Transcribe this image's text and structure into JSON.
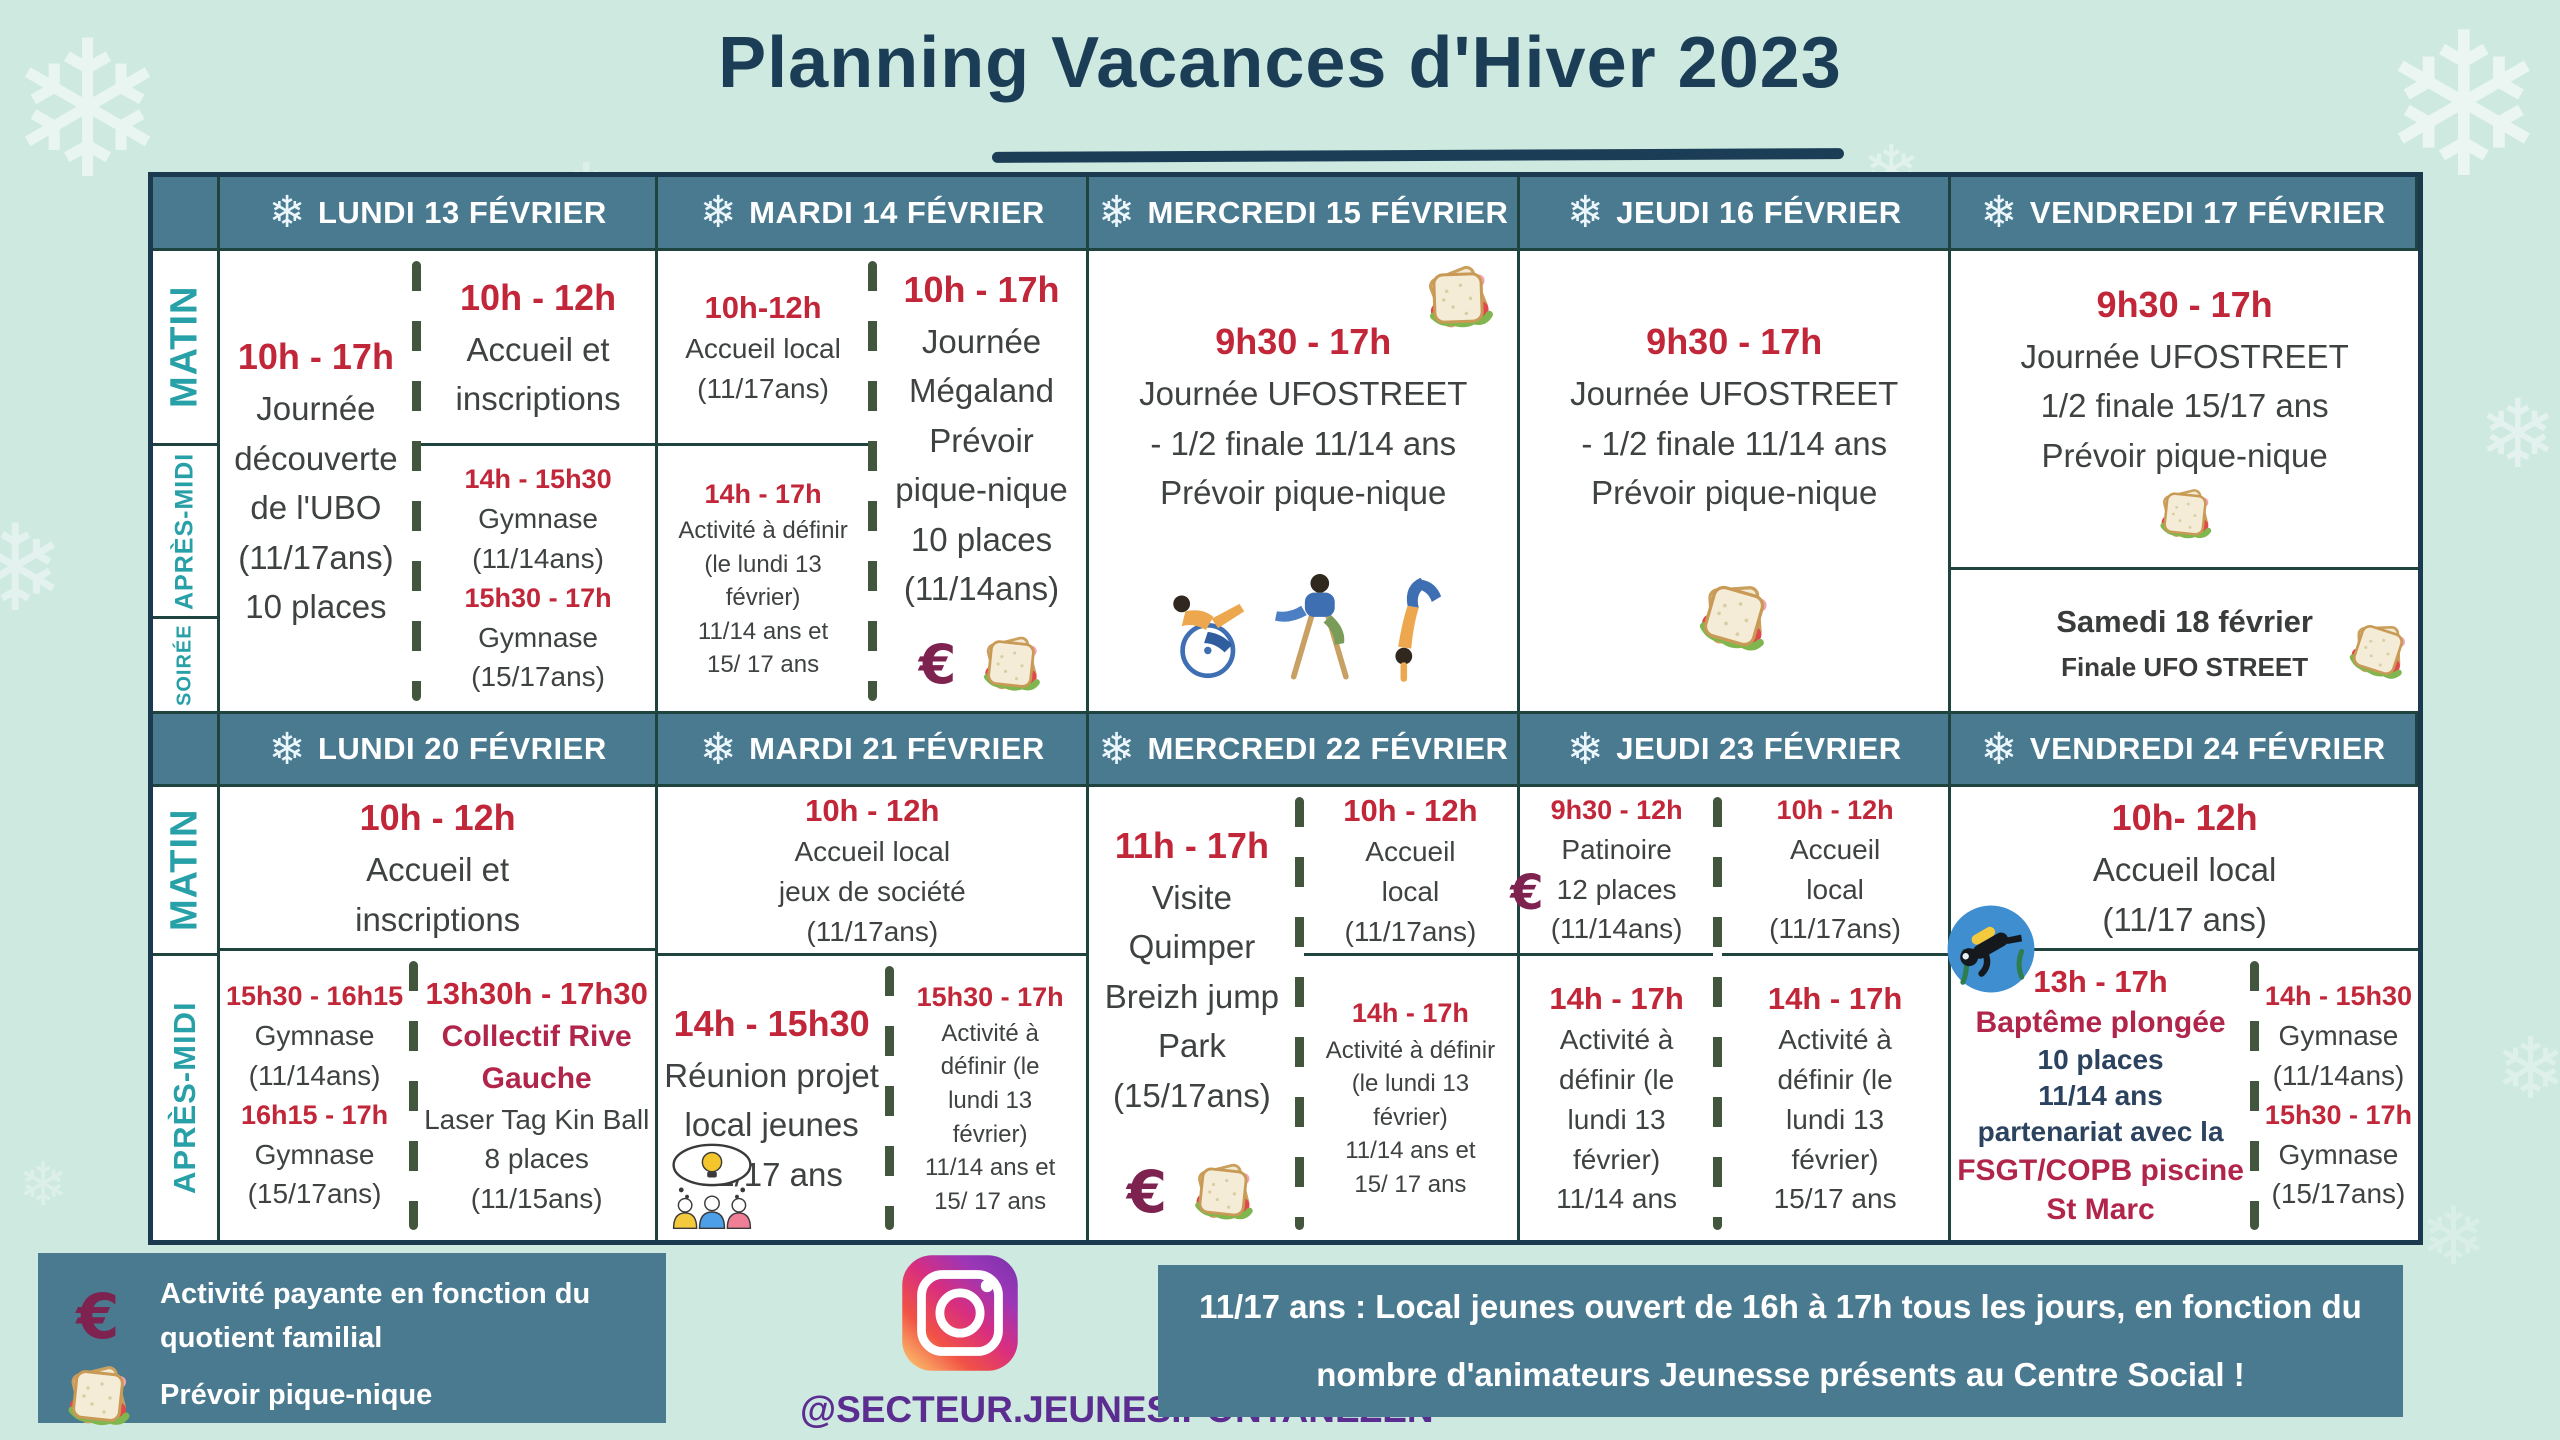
{
  "title": {
    "text": "Planning Vacances d'Hiver 2023"
  },
  "icons": {
    "snowflake": "❄",
    "euro": "€",
    "sandwich": "sandwich-icon",
    "instagram": "instagram-icon",
    "diver": "scuba-diver-icon",
    "brainstorm": "team-brainstorm-icon",
    "dancers": "breakdancers-illustration"
  },
  "colors": {
    "background": "#cde9e0",
    "header_teal": "#4a7a90",
    "time_red": "#c12639",
    "body_text": "#3f4242",
    "special_crimson": "#b1254a",
    "navy": "#2c4360",
    "sidebar_teal": "#28a0a8",
    "title_navy": "#1c3d56",
    "euro_maroon": "#7e2250",
    "instagram_purple": "#5b2d90",
    "grid_line": "#1f4440",
    "dash_green": "#42563e"
  },
  "week1": {
    "headers": [
      "LUNDI 13 FÉVRIER",
      "MARDI 14 FÉVRIER",
      "MERCREDI 15 FÉVRIER",
      "JEUDI 16 FÉVRIER",
      "VENDREDI 17 FÉVRIER"
    ],
    "row_labels": [
      "MATIN",
      "APRÈS-MIDI",
      "SOIRÉE"
    ],
    "monday": {
      "full_day": [
        {
          "t": "10h - 17h",
          "k": "t1"
        },
        {
          "t": "Journée",
          "k": "d1"
        },
        {
          "t": "découverte",
          "k": "d1"
        },
        {
          "t": "de l'UBO",
          "k": "d1"
        },
        {
          "t": "(11/17ans)",
          "k": "d1"
        },
        {
          "t": "10 places",
          "k": "d1"
        }
      ],
      "morning": [
        {
          "t": "10h - 12h",
          "k": "t1"
        },
        {
          "t": "Accueil et",
          "k": "d1"
        },
        {
          "t": "inscriptions",
          "k": "d1"
        }
      ],
      "afternoon": [
        {
          "t": "14h - 15h30",
          "k": "t3"
        },
        {
          "t": "Gymnase",
          "k": "d2"
        },
        {
          "t": "(11/14ans)",
          "k": "d2"
        },
        {
          "t": "15h30 - 17h",
          "k": "t3"
        },
        {
          "t": "Gymnase",
          "k": "d2"
        },
        {
          "t": "(15/17ans)",
          "k": "d2"
        }
      ]
    },
    "tuesday": {
      "morning": [
        {
          "t": "10h-12h",
          "k": "t2"
        },
        {
          "t": "Accueil local",
          "k": "d2"
        },
        {
          "t": "(11/17ans)",
          "k": "d2"
        }
      ],
      "afternoon": [
        {
          "t": "14h - 17h",
          "k": "t3"
        },
        {
          "t": "Activité à définir",
          "k": "d3"
        },
        {
          "t": "(le lundi 13",
          "k": "d3"
        },
        {
          "t": "février)",
          "k": "d3"
        },
        {
          "t": "11/14 ans et",
          "k": "d3"
        },
        {
          "t": "15/ 17 ans",
          "k": "d3"
        }
      ],
      "full_day": [
        {
          "t": "10h - 17h",
          "k": "t1"
        },
        {
          "t": "Journée",
          "k": "d1"
        },
        {
          "t": "Mégaland",
          "k": "d1"
        },
        {
          "t": "Prévoir",
          "k": "d1"
        },
        {
          "t": "pique-nique",
          "k": "d1"
        },
        {
          "t": "10 places",
          "k": "d1"
        },
        {
          "t": "(11/14ans)",
          "k": "d1"
        }
      ]
    },
    "wednesday": {
      "full_day": [
        {
          "t": "9h30 - 17h",
          "k": "t1"
        },
        {
          "t": "Journée UFOSTREET",
          "k": "d1"
        },
        {
          "t": "- 1/2 finale 11/14 ans",
          "k": "d1"
        },
        {
          "t": "Prévoir pique-nique",
          "k": "d1"
        }
      ]
    },
    "thursday": {
      "full_day": [
        {
          "t": "9h30 - 17h",
          "k": "t1"
        },
        {
          "t": "Journée UFOSTREET",
          "k": "d1"
        },
        {
          "t": "- 1/2 finale 11/14 ans",
          "k": "d1"
        },
        {
          "t": "Prévoir pique-nique",
          "k": "d1"
        }
      ]
    },
    "friday": {
      "full_day": [
        {
          "t": "9h30 - 17h",
          "k": "t1"
        },
        {
          "t": "Journée UFOSTREET",
          "k": "d1"
        },
        {
          "t": "1/2 finale 15/17 ans",
          "k": "d1"
        },
        {
          "t": "Prévoir pique-nique",
          "k": "d1"
        }
      ],
      "saturday_note": [
        {
          "t": "Samedi 18 février",
          "k": "b1"
        },
        {
          "t": "Finale UFO STREET",
          "k": "b2"
        }
      ]
    }
  },
  "week2": {
    "headers": [
      "LUNDI 20 FÉVRIER",
      "MARDI 21 FÉVRIER",
      "MERCREDI 22 FÉVRIER",
      "JEUDI 23 FÉVRIER",
      "VENDREDI 24 FÉVRIER"
    ],
    "row_labels": [
      "MATIN",
      "APRÈS-MIDI"
    ],
    "monday": {
      "morning": [
        {
          "t": "10h - 12h",
          "k": "t1"
        },
        {
          "t": "Accueil et",
          "k": "d1"
        },
        {
          "t": "inscriptions",
          "k": "d1"
        }
      ],
      "afternoon_left": [
        {
          "t": "15h30 - 16h15",
          "k": "t3"
        },
        {
          "t": "Gymnase",
          "k": "d2"
        },
        {
          "t": "(11/14ans)",
          "k": "d2"
        },
        {
          "t": "16h15 - 17h",
          "k": "t3"
        },
        {
          "t": "Gymnase",
          "k": "d2"
        },
        {
          "t": "(15/17ans)",
          "k": "d2"
        }
      ],
      "afternoon_right": [
        {
          "t": "13h30h - 17h30",
          "k": "t2"
        },
        {
          "t": "Collectif Rive",
          "k": "c1"
        },
        {
          "t": "Gauche",
          "k": "c1"
        },
        {
          "t": "Laser Tag Kin Ball",
          "k": "d2"
        },
        {
          "t": "8 places",
          "k": "d2"
        },
        {
          "t": "(11/15ans)",
          "k": "d2"
        }
      ]
    },
    "tuesday": {
      "morning": [
        {
          "t": "10h - 12h",
          "k": "t2"
        },
        {
          "t": "Accueil local",
          "k": "d2"
        },
        {
          "t": "jeux de société",
          "k": "d2"
        },
        {
          "t": "(11/17ans)",
          "k": "d2"
        }
      ],
      "afternoon_left": [
        {
          "t": "14h - 15h30",
          "k": "t1"
        },
        {
          "t": "Réunion  projet",
          "k": "d1"
        },
        {
          "t": "local jeunes",
          "k": "d1"
        },
        {
          "t": "11/17 ans",
          "k": "d1"
        }
      ],
      "afternoon_right": [
        {
          "t": "15h30 - 17h",
          "k": "t3"
        },
        {
          "t": "Activité à",
          "k": "d3"
        },
        {
          "t": "définir (le",
          "k": "d3"
        },
        {
          "t": "lundi 13",
          "k": "d3"
        },
        {
          "t": "février)",
          "k": "d3"
        },
        {
          "t": "11/14 ans et",
          "k": "d3"
        },
        {
          "t": "15/ 17 ans",
          "k": "d3"
        }
      ]
    },
    "wednesday": {
      "full_day": [
        {
          "t": "11h - 17h",
          "k": "t1"
        },
        {
          "t": "Visite",
          "k": "d1"
        },
        {
          "t": "Quimper",
          "k": "d1"
        },
        {
          "t": "Breizh jump",
          "k": "d1"
        },
        {
          "t": "Park",
          "k": "d1"
        },
        {
          "t": "(15/17ans)",
          "k": "d1"
        }
      ],
      "morning": [
        {
          "t": "10h - 12h",
          "k": "t2"
        },
        {
          "t": "Accueil",
          "k": "d2"
        },
        {
          "t": "local",
          "k": "d2"
        },
        {
          "t": "(11/17ans)",
          "k": "d2"
        }
      ],
      "afternoon": [
        {
          "t": "14h - 17h",
          "k": "t3"
        },
        {
          "t": "Activité à définir",
          "k": "d3"
        },
        {
          "t": "(le lundi 13",
          "k": "d3"
        },
        {
          "t": "février)",
          "k": "d3"
        },
        {
          "t": "11/14 ans et",
          "k": "d3"
        },
        {
          "t": "15/ 17 ans",
          "k": "d3"
        }
      ]
    },
    "thursday": {
      "morning_left": [
        {
          "t": "9h30 - 12h",
          "k": "t3"
        },
        {
          "t": "Patinoire",
          "k": "d2"
        },
        {
          "t": "12 places",
          "k": "d2"
        },
        {
          "t": "(11/14ans)",
          "k": "d2"
        }
      ],
      "morning_right": [
        {
          "t": "10h - 12h",
          "k": "t3"
        },
        {
          "t": "Accueil",
          "k": "d2"
        },
        {
          "t": "local",
          "k": "d2"
        },
        {
          "t": "(11/17ans)",
          "k": "d2"
        }
      ],
      "afternoon_left": [
        {
          "t": "14h - 17h",
          "k": "t2"
        },
        {
          "t": "Activité à",
          "k": "d2"
        },
        {
          "t": "définir (le",
          "k": "d2"
        },
        {
          "t": "lundi 13",
          "k": "d2"
        },
        {
          "t": "février)",
          "k": "d2"
        },
        {
          "t": "11/14 ans",
          "k": "d2"
        }
      ],
      "afternoon_right": [
        {
          "t": "14h - 17h",
          "k": "t2"
        },
        {
          "t": "Activité à",
          "k": "d2"
        },
        {
          "t": "définir (le",
          "k": "d2"
        },
        {
          "t": "lundi 13",
          "k": "d2"
        },
        {
          "t": "février)",
          "k": "d2"
        },
        {
          "t": "15/17 ans",
          "k": "d2"
        }
      ]
    },
    "friday": {
      "morning": [
        {
          "t": "10h- 12h",
          "k": "t1"
        },
        {
          "t": "Accueil local",
          "k": "d1"
        },
        {
          "t": "(11/17 ans)",
          "k": "d1"
        }
      ],
      "afternoon_left": [
        {
          "t": "13h - 17h",
          "k": "t2"
        },
        {
          "t": "Baptême plongée",
          "k": "c1"
        },
        {
          "t": "10 places",
          "k": "n1"
        },
        {
          "t": "11/14 ans",
          "k": "n1"
        },
        {
          "t": "partenariat avec la",
          "k": "n1"
        },
        {
          "t": "FSGT/COPB piscine",
          "k": "c1"
        },
        {
          "t": "St Marc",
          "k": "c1"
        }
      ],
      "afternoon_right": [
        {
          "t": "14h - 15h30",
          "k": "t3"
        },
        {
          "t": "Gymnase",
          "k": "d2"
        },
        {
          "t": "(11/14ans)",
          "k": "d2"
        },
        {
          "t": "15h30 - 17h",
          "k": "t3"
        },
        {
          "t": "Gymnase",
          "k": "d2"
        },
        {
          "t": "(15/17ans)",
          "k": "d2"
        }
      ]
    }
  },
  "legend": {
    "items": [
      {
        "icon": "euro-icon",
        "text": "Activité payante en fonction du quotient familial"
      },
      {
        "icon": "sandwich-icon",
        "text": "Prévoir pique-nique"
      }
    ]
  },
  "instagram": {
    "handle": "@SECTEUR.JEUNES.PONTANEZEN"
  },
  "banner": {
    "lines": [
      {
        "t": "11/17 ans : Local jeunes ouvert de 16h à 17h tous les jours, en fonction du",
        "k": "w1"
      },
      {
        "t": "nombre d'animateurs Jeunesse présents  au Centre Social !",
        "k": "w1"
      }
    ]
  }
}
